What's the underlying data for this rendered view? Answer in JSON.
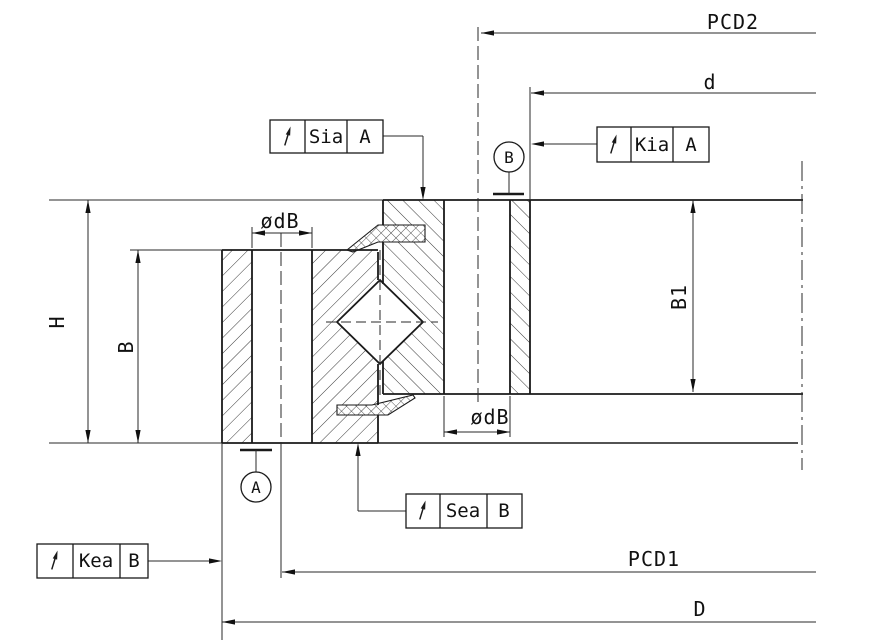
{
  "drawing": {
    "dimensions": {
      "pcd2": "PCD2",
      "d": "d",
      "pcd1": "PCD1",
      "outer_diameter": "D",
      "total_height": "H",
      "inner_ring_height": "B",
      "outer_ring_height": "B1",
      "bolt_hole_inner_ring": "ødB",
      "bolt_hole_outer_ring": "ødB"
    },
    "datums": {
      "a": "A",
      "b": "B"
    },
    "frames": {
      "sia": {
        "symbol": "circular-runout",
        "label": "Sia",
        "datum": "A"
      },
      "kia": {
        "symbol": "circular-runout",
        "label": "Kia",
        "datum": "A"
      },
      "sea": {
        "symbol": "circular-runout",
        "label": "Sea",
        "datum": "B"
      },
      "kea": {
        "symbol": "circular-runout",
        "label": "Kea",
        "datum": "B"
      }
    },
    "colors": {
      "line": "#1a1a1a",
      "background": "#ffffff"
    }
  }
}
